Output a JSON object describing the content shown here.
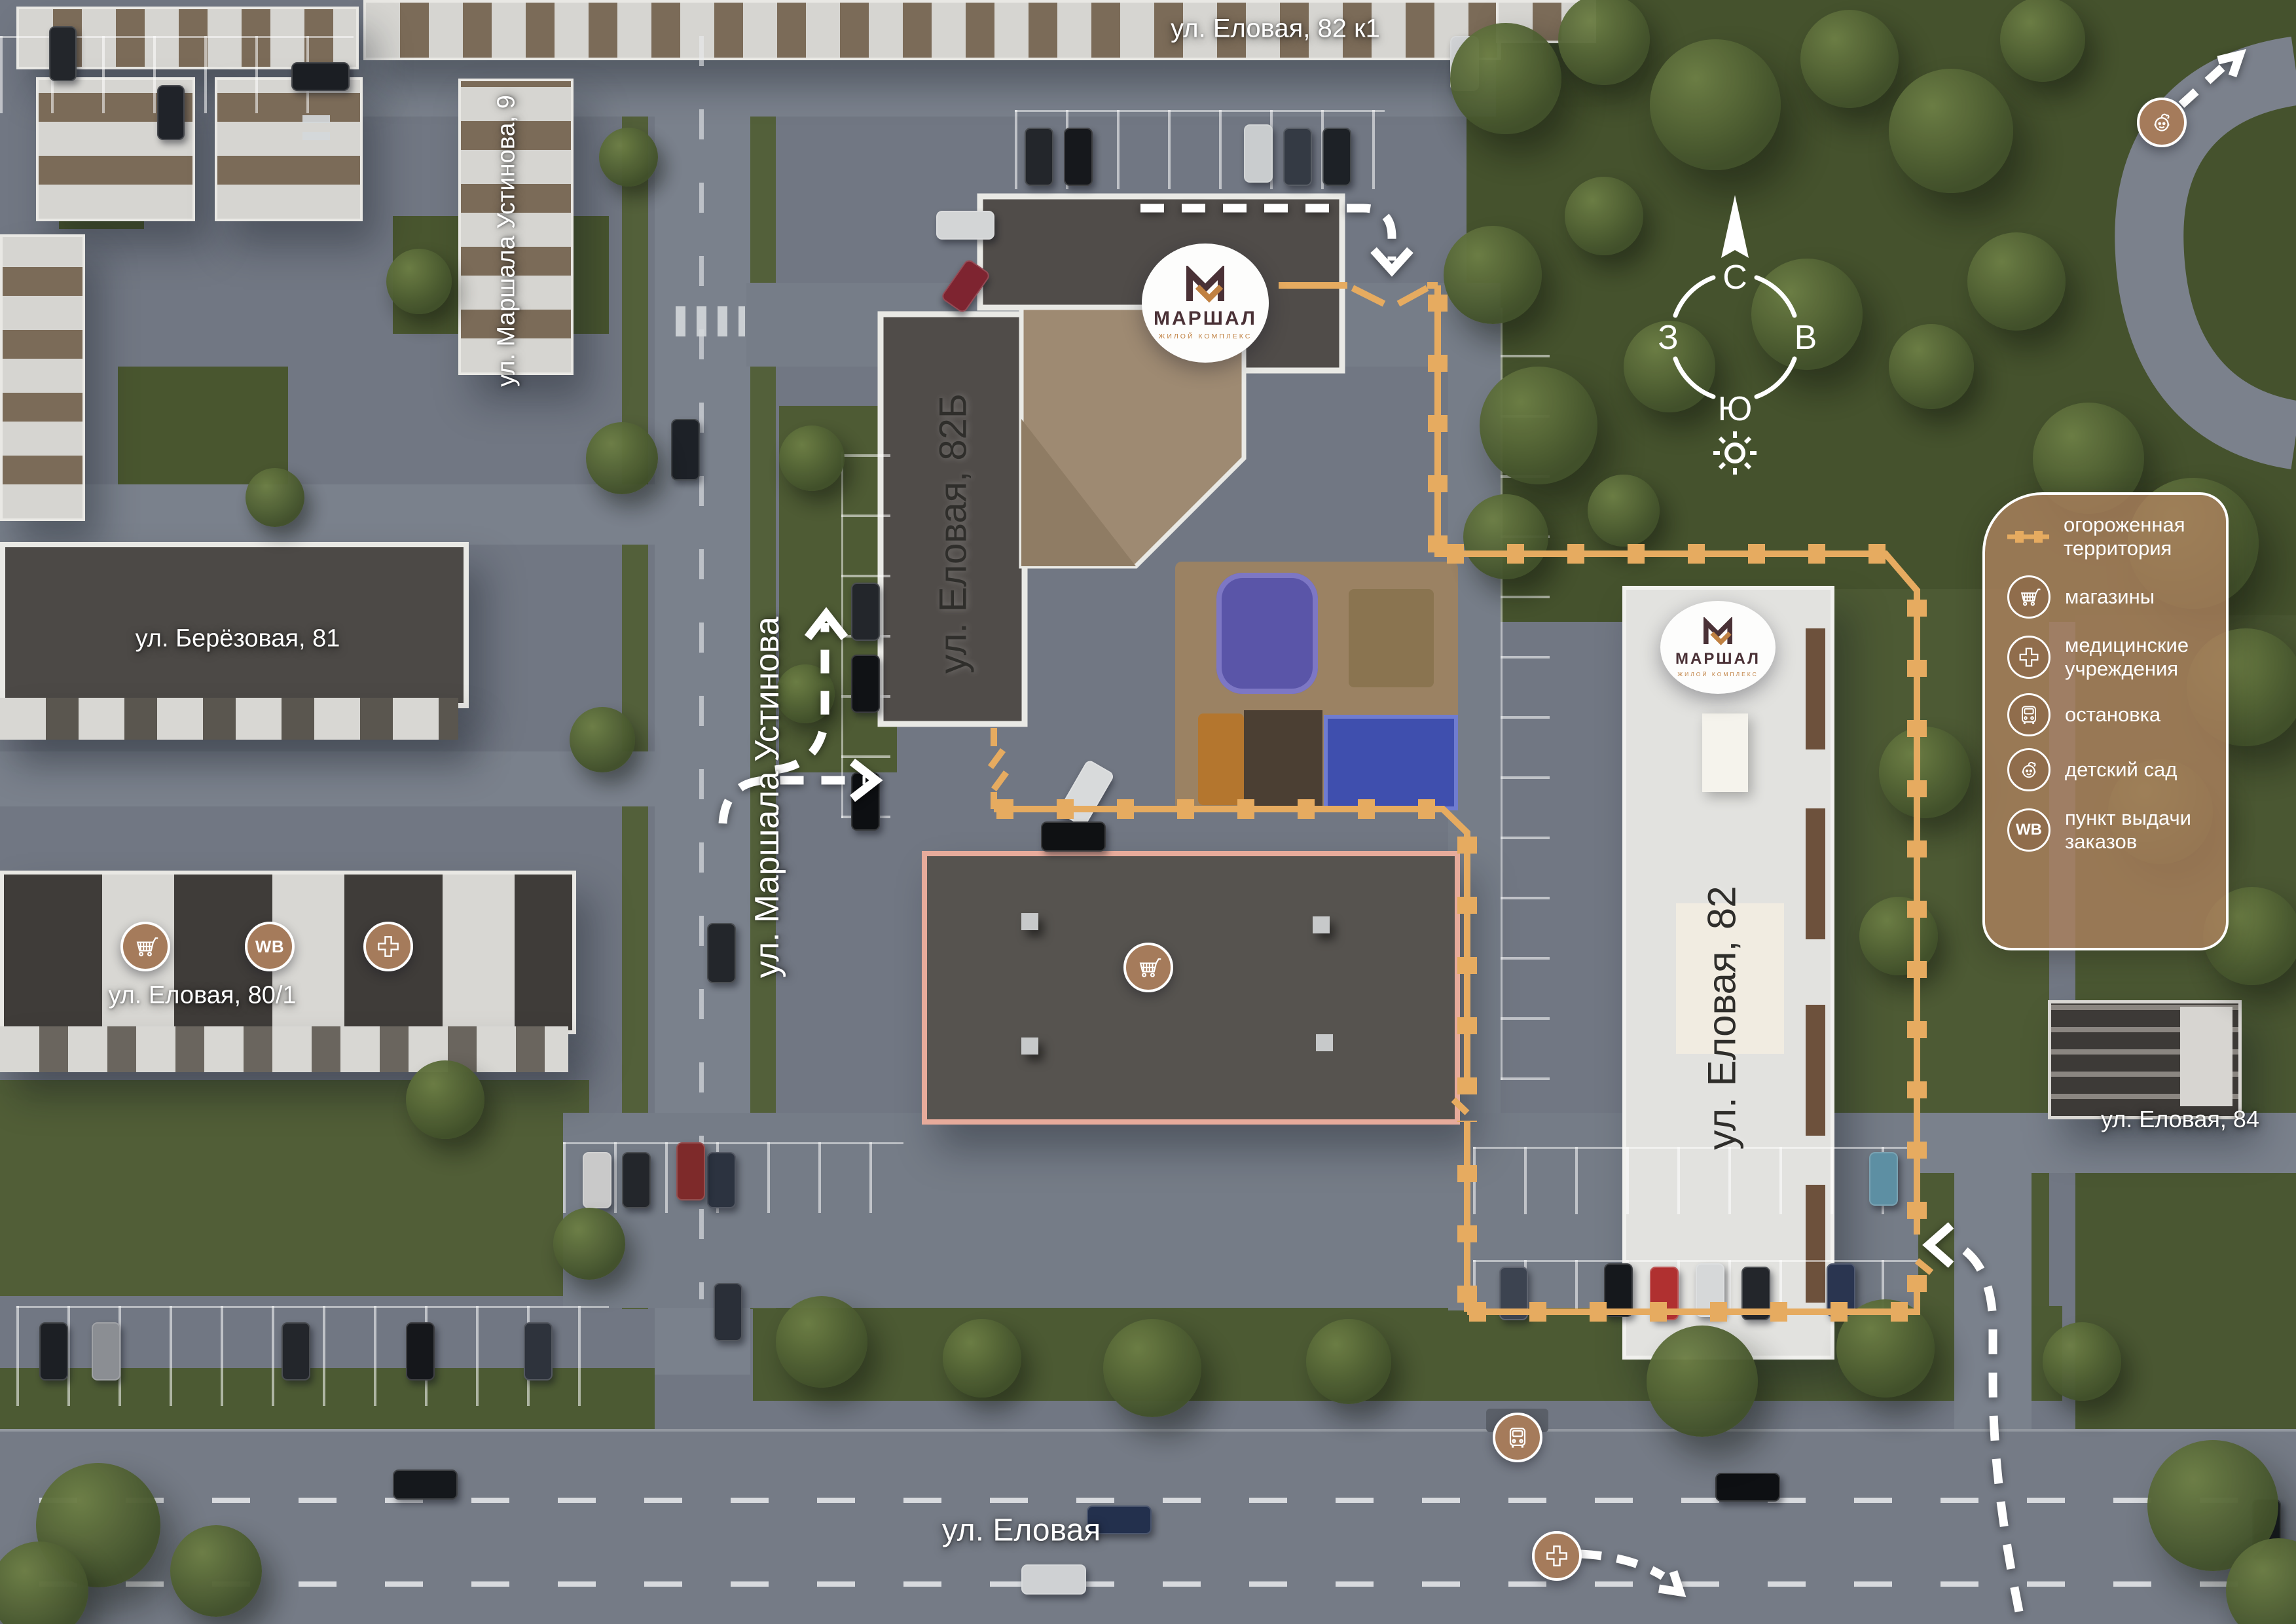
{
  "brand": {
    "name": "МАРШАЛ",
    "subtitle": "ЖИЛОЙ КОМПЛЕКС"
  },
  "compass": {
    "north": "С",
    "east": "В",
    "south": "Ю",
    "west": "З"
  },
  "street_labels": {
    "elovaya_82k1": "ул. Еловая, 82 к1",
    "marshala_ustinova_9": "ул. Маршала Устинова, 9",
    "marshala_ustinova": "ул. Маршала Устинова",
    "berezovaya_81": "ул. Берёзовая, 81",
    "elovaya_80_1": "ул. Еловая, 80/1",
    "elovaya_82b": "ул. Еловая, 82Б",
    "elovaya_82": "ул. Еловая, 82",
    "elovaya_84": "ул. Еловая, 84",
    "elovaya": "ул. Еловая"
  },
  "legend": {
    "items": [
      {
        "icon": "fence-line",
        "label": "огороженная территория"
      },
      {
        "icon": "shopping-cart",
        "label": "магазины"
      },
      {
        "icon": "medical-cross",
        "label": "медицинские учреждения"
      },
      {
        "icon": "bus",
        "label": "остановка"
      },
      {
        "icon": "child-face",
        "label": "детский сад"
      },
      {
        "icon": "wb",
        "label": "пункт выдачи заказов"
      }
    ]
  },
  "poi_markers": [
    {
      "type": "shopping-cart"
    },
    {
      "type": "wb-pickup"
    },
    {
      "type": "medical-cross"
    },
    {
      "type": "shopping-cart"
    },
    {
      "type": "bus-stop"
    },
    {
      "type": "medical-cross"
    },
    {
      "type": "kindergarten"
    }
  ],
  "wb_text": "WB",
  "colors": {
    "fence": "#E6AB60",
    "marker": "#A57B5B",
    "brand_dark": "#4A3136",
    "brand_orange": "#C08142",
    "legend_bg": "rgba(170,128,93,0.82)"
  }
}
